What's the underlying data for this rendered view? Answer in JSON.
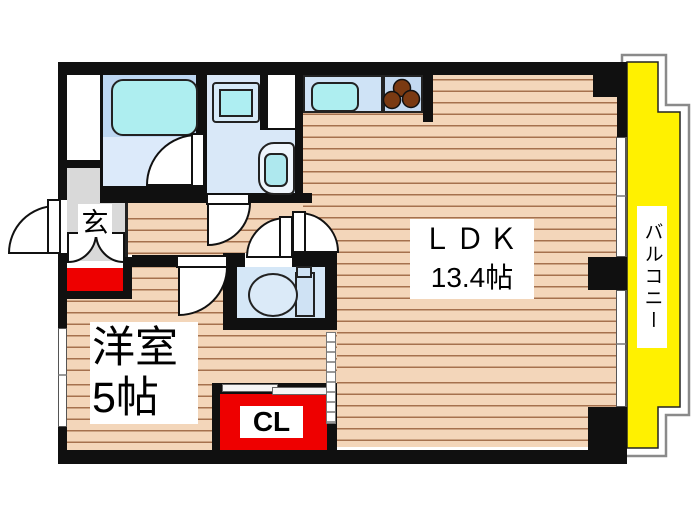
{
  "plan_title": "apartment-floor-plan",
  "rooms": {
    "ldk": {
      "name": "ＬＤＫ",
      "size": "13.4帖"
    },
    "western": {
      "name": "洋室",
      "size": "5帖"
    },
    "closet": {
      "label": "CL"
    },
    "entrance": {
      "label": "玄"
    },
    "balcony": {
      "label": "バルコニー"
    }
  },
  "fixtures": [
    "bathtub",
    "washing-machine-pan",
    "washbasin",
    "toilet",
    "kitchen-sink",
    "stove-burners",
    "shoe-cabinet",
    "sliding-partition",
    "closet-sliding-doors",
    "entrance-door",
    "balcony-windows"
  ],
  "colors": {
    "wall": "#101010",
    "wood_floor": "#F3D6BA",
    "wood_line": "#A5714E",
    "room_blue": "#D9E8F8",
    "fixture_cyan": "#AEEEF0",
    "balcony_yellow": "#FFF100",
    "closet_red": "#EE0000",
    "genkan_gray": "#D9D9D9"
  }
}
